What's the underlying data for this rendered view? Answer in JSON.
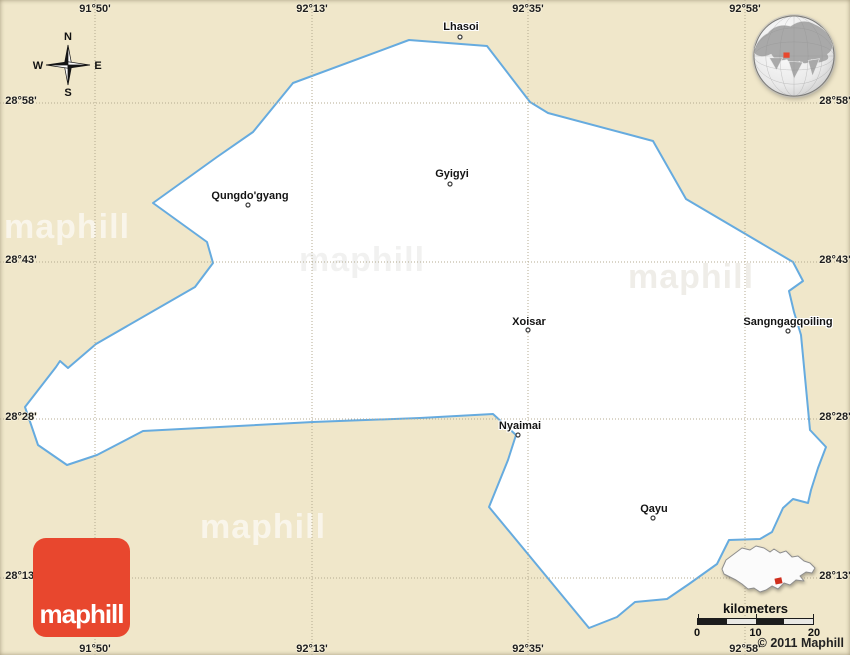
{
  "map": {
    "background_color": "#f0e7ca",
    "region_boundary": {
      "fill_color": "#ffffff",
      "stroke_color": "#66abdf",
      "points": [
        [
          409,
          40
        ],
        [
          487,
          46
        ],
        [
          530,
          102
        ],
        [
          548,
          113
        ],
        [
          653,
          141
        ],
        [
          686,
          199
        ],
        [
          793,
          262
        ],
        [
          803,
          281
        ],
        [
          789,
          291
        ],
        [
          794,
          312
        ],
        [
          801,
          335
        ],
        [
          810,
          430
        ],
        [
          826,
          447
        ],
        [
          818,
          468
        ],
        [
          811,
          490
        ],
        [
          808,
          503
        ],
        [
          793,
          499
        ],
        [
          783,
          508
        ],
        [
          772,
          532
        ],
        [
          760,
          539
        ],
        [
          729,
          540
        ],
        [
          717,
          564
        ],
        [
          689,
          584
        ],
        [
          667,
          599
        ],
        [
          635,
          602
        ],
        [
          617,
          617
        ],
        [
          589,
          628
        ],
        [
          489,
          507
        ],
        [
          508,
          460
        ],
        [
          516,
          435
        ],
        [
          493,
          414
        ],
        [
          420,
          418
        ],
        [
          313,
          422
        ],
        [
          143,
          431
        ],
        [
          97,
          455
        ],
        [
          67,
          465
        ],
        [
          38,
          445
        ],
        [
          25,
          407
        ],
        [
          56,
          367
        ],
        [
          60,
          361
        ],
        [
          68,
          368
        ],
        [
          96,
          344
        ],
        [
          195,
          287
        ],
        [
          213,
          263
        ],
        [
          207,
          242
        ],
        [
          153,
          203
        ],
        [
          217,
          157
        ],
        [
          253,
          132
        ],
        [
          293,
          83
        ]
      ]
    },
    "grid": {
      "meridians": [
        {
          "label": "91°50'",
          "x": 95
        },
        {
          "label": "92°13'",
          "x": 312
        },
        {
          "label": "92°35'",
          "x": 528
        },
        {
          "label": "92°58'",
          "x": 745
        }
      ],
      "parallels": [
        {
          "label": "28°58'",
          "y": 103
        },
        {
          "label": "28°43'",
          "y": 262
        },
        {
          "label": "28°28'",
          "y": 419
        },
        {
          "label": "28°13'",
          "y": 578
        }
      ]
    },
    "places": [
      {
        "name": "Lhasoi",
        "x": 461,
        "y": 27,
        "dot_x": 460,
        "dot_y": 37
      },
      {
        "name": "Gyigyi",
        "x": 452,
        "y": 174,
        "dot_x": 450,
        "dot_y": 184
      },
      {
        "name": "Qungdo'gyang",
        "x": 250,
        "y": 196,
        "dot_x": 248,
        "dot_y": 205
      },
      {
        "name": "Xoisar",
        "x": 529,
        "y": 322,
        "dot_x": 528,
        "dot_y": 330
      },
      {
        "name": "Sangngagqoiling",
        "x": 788,
        "y": 322,
        "dot_x": 788,
        "dot_y": 331
      },
      {
        "name": "Nyaimai",
        "x": 520,
        "y": 426,
        "dot_x": 518,
        "dot_y": 435
      },
      {
        "name": "Qayu",
        "x": 654,
        "y": 509,
        "dot_x": 653,
        "dot_y": 518
      }
    ]
  },
  "compass": {
    "north": "N",
    "east": "E",
    "south": "S",
    "west": "W"
  },
  "watermarks": [
    {
      "text": "maphill",
      "x": 4,
      "baseline_y": 238,
      "style": "light"
    },
    {
      "text": "maphill",
      "x": 299,
      "baseline_y": 271,
      "style": "dark"
    },
    {
      "text": "maphill",
      "x": 628,
      "baseline_y": 288,
      "style": "faint"
    },
    {
      "text": "maphill",
      "x": 200,
      "baseline_y": 538,
      "style": "light"
    }
  ],
  "scale_bar": {
    "title": "kilometers",
    "tick_labels": [
      "0",
      "10",
      "20"
    ],
    "segment_colors": [
      "#1c1c1c",
      "#e9e8e4",
      "#1c1c1c",
      "#e9e8e4"
    ]
  },
  "branding": {
    "logo_text": "maphill",
    "logo_color": "#e8472e",
    "copyright": "© 2011 Maphill"
  },
  "insets": {
    "globe": {
      "marker_color": "#e8472e"
    },
    "region": {
      "marker_color": "#cf2f1e"
    }
  }
}
